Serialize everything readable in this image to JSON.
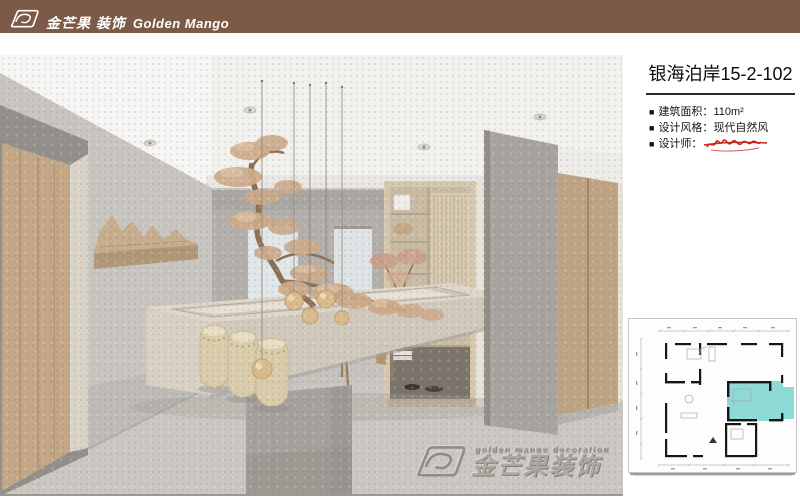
{
  "header": {
    "bar_color": "#7b5a47",
    "logo_zh": "金芒果 装饰",
    "logo_en": "Golden Mango"
  },
  "project": {
    "title": "银海泊岸15-2-102",
    "bullet": "■",
    "specs": [
      {
        "label": "建筑面积：",
        "value": "110m²"
      },
      {
        "label": "设计风格：",
        "value": "现代自然风"
      },
      {
        "label": "设计师：",
        "value": ""
      }
    ]
  },
  "watermark": {
    "line_en": "golden mango decoration",
    "line_zh": "金芒果装饰"
  },
  "floorplan": {
    "highlight_color": "#8edad7"
  },
  "colors": {
    "brand_brown": "#7b5a47",
    "signature_red": "#c2251c",
    "plan_highlight": "#8edad7"
  },
  "icons": {
    "brand_logo": "golden-mango-logo",
    "designer_signature": "red-handwritten-signature-strikethrough",
    "watermark_logo": "golden-mango-logo-embossed"
  }
}
